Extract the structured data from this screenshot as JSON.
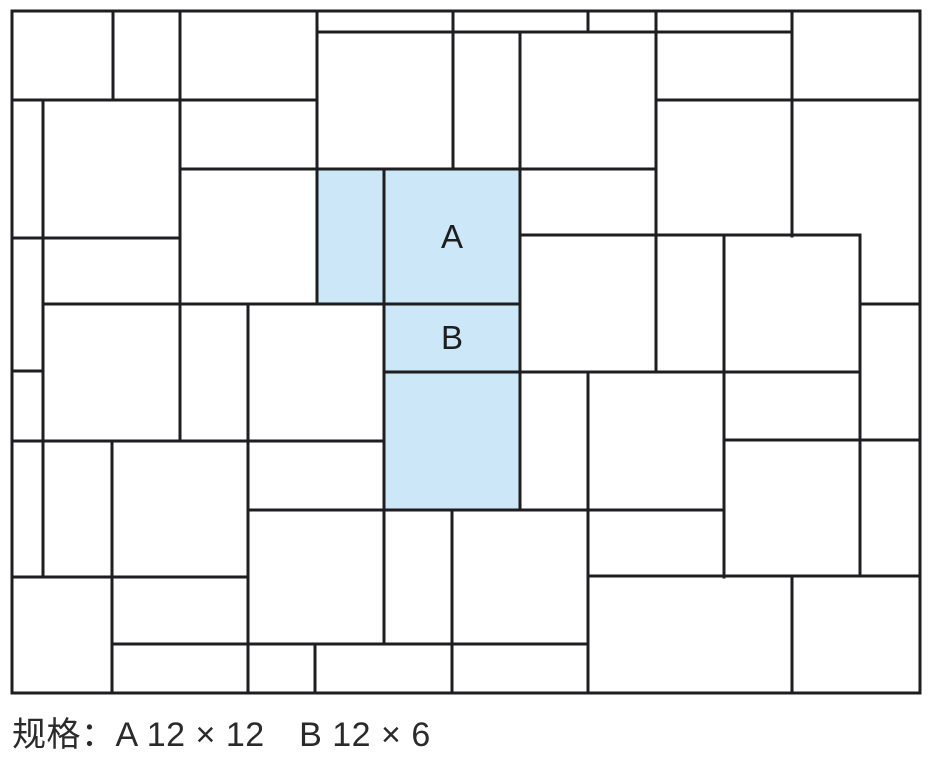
{
  "diagram": {
    "canvas": {
      "width": 928,
      "height": 772
    },
    "line_color": "#1e1e20",
    "line_width": 3,
    "highlight_fill": "#cbe7f8",
    "label_font_size": 33,
    "border": {
      "x1": 12,
      "y1": 11,
      "x2": 920,
      "y2": 693
    },
    "highlight_tiles": [
      {
        "name": "highlight-tile-b-vertical",
        "x": 317,
        "y": 169,
        "w": 67,
        "h": 135,
        "label": ""
      },
      {
        "name": "highlight-tile-a",
        "x": 384,
        "y": 169,
        "w": 136,
        "h": 135,
        "label": "A"
      },
      {
        "name": "highlight-tile-b",
        "x": 384,
        "y": 304,
        "w": 136,
        "h": 67,
        "label": "B"
      },
      {
        "name": "highlight-tile-a-lower",
        "x": 384,
        "y": 371,
        "w": 136,
        "h": 139,
        "label": ""
      }
    ],
    "v_segments": [
      [
        113,
        11,
        100
      ],
      [
        180,
        11,
        441
      ],
      [
        317,
        11,
        304
      ],
      [
        453,
        11,
        169
      ],
      [
        588,
        11,
        32
      ],
      [
        656,
        11,
        372
      ],
      [
        792,
        11,
        236
      ],
      [
        43,
        100,
        577
      ],
      [
        520,
        32,
        510
      ],
      [
        384,
        169,
        644
      ],
      [
        860,
        235,
        576
      ],
      [
        724,
        235,
        577
      ],
      [
        248,
        304,
        693
      ],
      [
        112,
        441,
        693
      ],
      [
        452,
        510,
        693
      ],
      [
        588,
        372,
        693
      ],
      [
        315,
        644,
        693
      ],
      [
        792,
        576,
        693
      ]
    ],
    "h_segments": [
      [
        32,
        317,
        792
      ],
      [
        100,
        12,
        317
      ],
      [
        100,
        656,
        920
      ],
      [
        169,
        180,
        656
      ],
      [
        235,
        520,
        860
      ],
      [
        238,
        12,
        180
      ],
      [
        304,
        43,
        520
      ],
      [
        304,
        860,
        920
      ],
      [
        371,
        12,
        43
      ],
      [
        372,
        384,
        860
      ],
      [
        441,
        12,
        384
      ],
      [
        440,
        724,
        920
      ],
      [
        510,
        248,
        724
      ],
      [
        577,
        12,
        248
      ],
      [
        576,
        588,
        920
      ],
      [
        644,
        112,
        588
      ]
    ]
  },
  "caption": {
    "text": "规格：A 12 × 12　B 12 × 6"
  }
}
